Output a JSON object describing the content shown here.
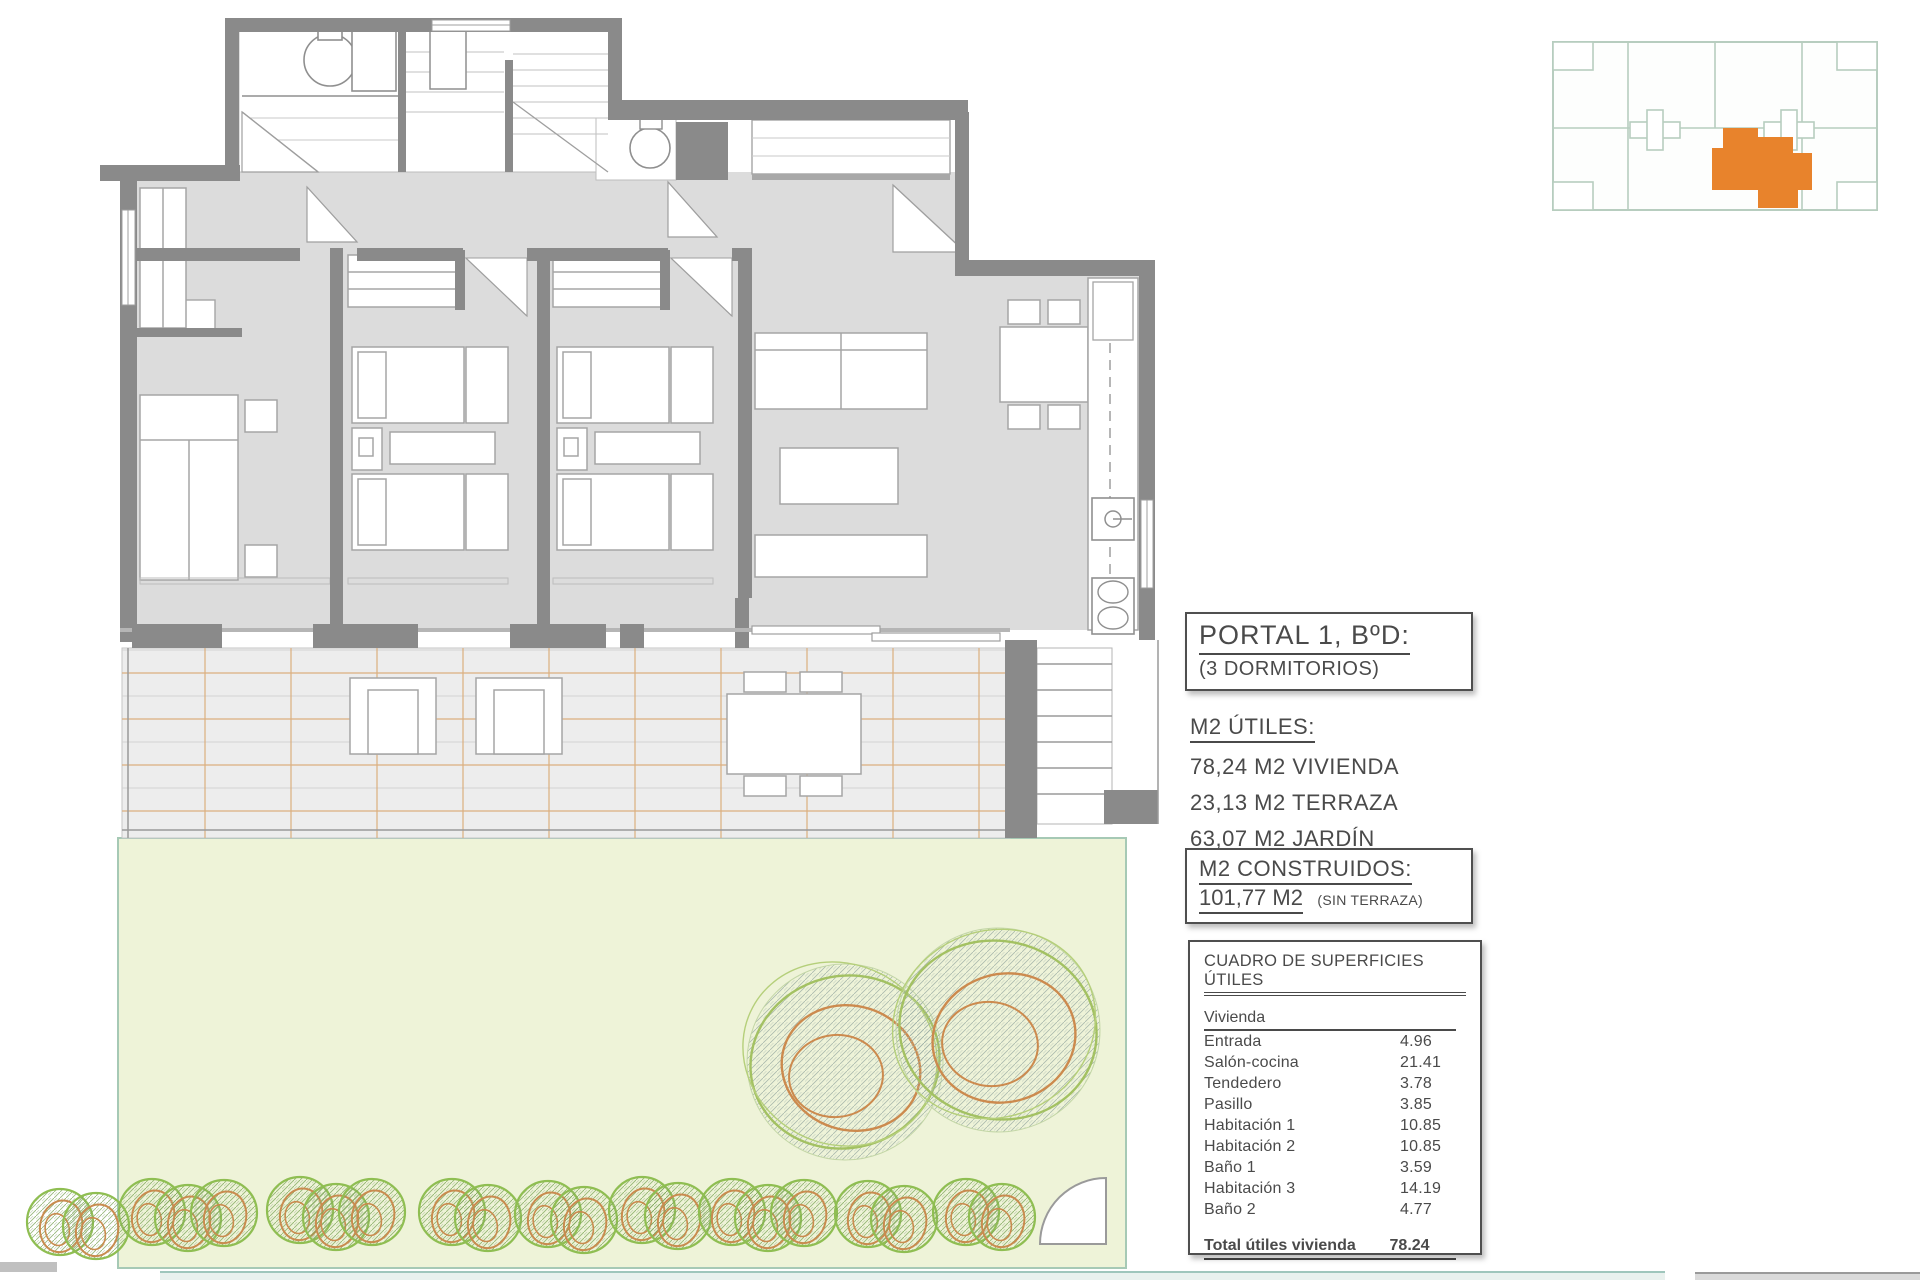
{
  "portal_box": {
    "title": "PORTAL 1, BºD:",
    "subtitle": "(3 DORMITORIOS)"
  },
  "m2_utiles": {
    "heading": "M2 ÚTILES:",
    "lines": [
      "78,24 M2 VIVIENDA",
      "23,13 M2 TERRAZA",
      "63,07 M2 JARDÍN"
    ]
  },
  "m2_construidos": {
    "heading": "M2 CONSTRUIDOS:",
    "value": "101,77 M2",
    "note": "(SIN TERRAZA)"
  },
  "surfaces_table": {
    "title": "CUADRO DE SUPERFICIES ÚTILES",
    "section": "Vivienda",
    "rows": [
      {
        "label": "Entrada",
        "value": "4.96"
      },
      {
        "label": "Salón-cocina",
        "value": "21.41"
      },
      {
        "label": "Tendedero",
        "value": "3.78"
      },
      {
        "label": "Pasillo",
        "value": "3.85"
      },
      {
        "label": "Habitación 1",
        "value": "10.85"
      },
      {
        "label": "Habitación 2",
        "value": "10.85"
      },
      {
        "label": "Baño 1",
        "value": "3.59"
      },
      {
        "label": "Habitación 3",
        "value": "14.19"
      },
      {
        "label": "Baño 2",
        "value": "4.77"
      }
    ],
    "total": {
      "label": "Total útiles vivienda",
      "value": "78.24"
    }
  },
  "colors": {
    "wall": "#8a8a8a",
    "floor": "#dcdcdc",
    "terrace_grid": "#dcaf7f",
    "garden": "#eef3d8",
    "tree_green": "#9cbe57",
    "tree_orange": "#cb8a50",
    "highlight_unit": "#E8832C",
    "keyplan_line": "#b7cdbf"
  }
}
